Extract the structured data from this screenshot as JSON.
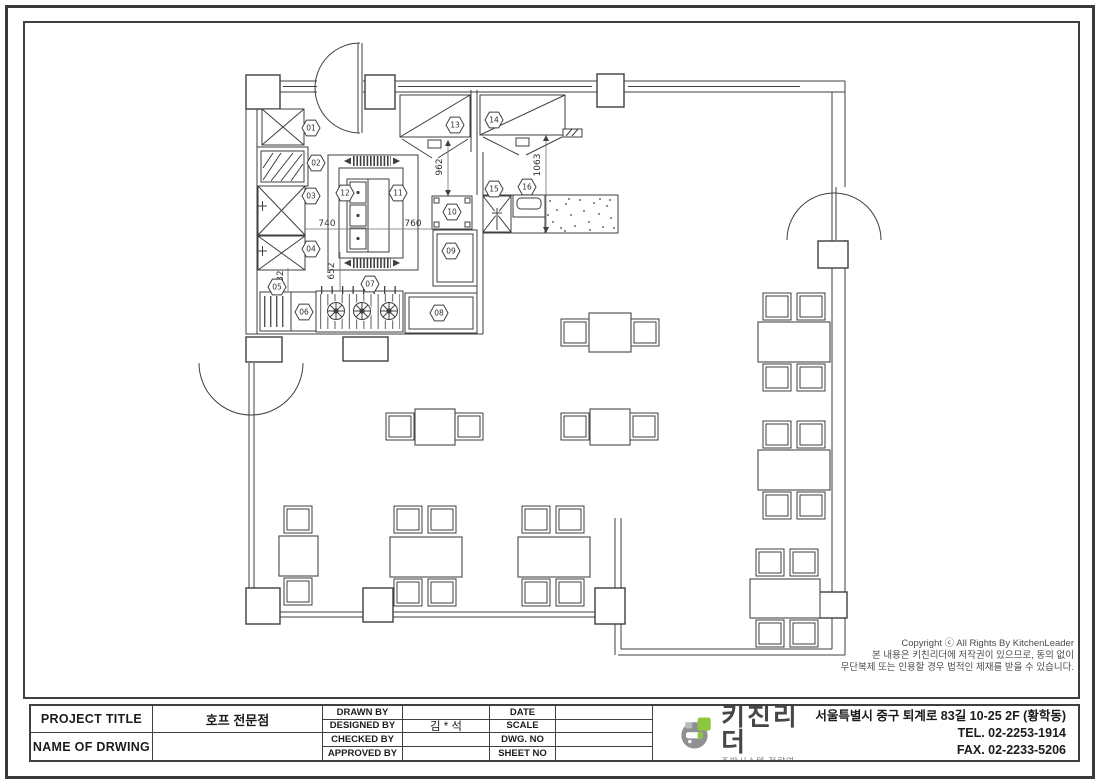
{
  "plan": {
    "callouts": [
      "01",
      "02",
      "03",
      "04",
      "05",
      "06",
      "07",
      "08",
      "09",
      "10",
      "11",
      "12",
      "13",
      "14",
      "15",
      "16"
    ],
    "dimensions": [
      "740",
      "760",
      "652",
      "532",
      "962",
      "1063"
    ]
  },
  "copyright": {
    "line1": "Copyright ⓒ All Rights By KitchenLeader",
    "line2": "본 내용은 키친리더에 저작권이 있으므로, 동의 없이",
    "line3": "무단복제 또는 인용할 경우 법적인 제재를 받을 수 있습니다."
  },
  "title_block": {
    "project_title_label": "PROJECT TITLE",
    "project_title_value": "호프 전문점",
    "name_of_drawing_label": "NAME OF DRWING",
    "name_of_drawing_value": "",
    "sign_rows": [
      {
        "label": "DRAWN BY",
        "value": ""
      },
      {
        "label": "DESIGNED BY",
        "value": "김 * 석"
      },
      {
        "label": "CHECKED BY",
        "value": ""
      },
      {
        "label": "APPROVED BY",
        "value": ""
      }
    ],
    "meta_rows": [
      {
        "label": "DATE",
        "value": ""
      },
      {
        "label": "SCALE",
        "value": ""
      },
      {
        "label": "DWG. NO",
        "value": ""
      },
      {
        "label": "SHEET NO",
        "value": ""
      }
    ]
  },
  "brand": {
    "name": "키친리더",
    "tagline_left": "맞춤형",
    "tagline_right": " 주방설계",
    "subtitle": "주방시스템 전략연구소",
    "address": "서울특별시 중구 퇴계로 83길 10-25 2F (황학동)",
    "tel": "TEL. 02-2253-1914",
    "fax": "FAX. 02-2233-5206",
    "colors": {
      "green": "#8dc63f",
      "orange": "#f7941d",
      "gray": "#8f9092",
      "line": "#3f3f3f"
    }
  }
}
